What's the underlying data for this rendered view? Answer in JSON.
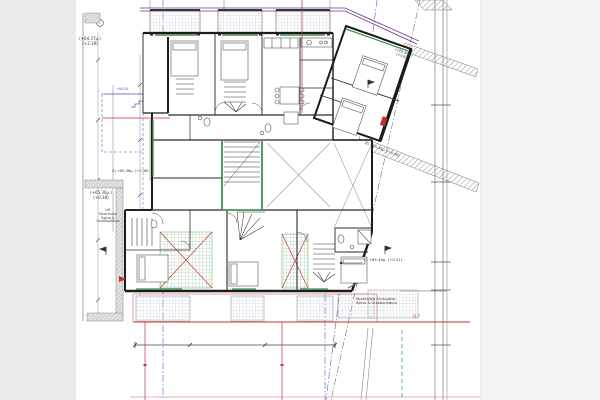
{
  "meta": {
    "kind": "architectural-floor-plan",
    "style": "CAD line drawing, top view, orthogonal building with rotated wing"
  },
  "palette": {
    "paper": "#ffffff",
    "margin_left": "#ebebeb",
    "margin_right": "#f3f3f2",
    "wall": "#1b1b1b",
    "green_accent": "#3f8f4f",
    "green_hatch": "#8fbc8f",
    "red_marker": "#c03030",
    "pink_boundary": "#cc7788",
    "blue_axis": "#5560c0",
    "purple_canopy": "#6a3a8a",
    "survey_gray": "#8a8a8a"
  },
  "annotations": {
    "level_top_left": {
      "line1": "(+64.37μ.)",
      "line2": "(+2.39)"
    },
    "level_left_small": {
      "line1": "(+65.36μ.)",
      "line2": "(+0.38)"
    },
    "level_z": "Ζ) +65.36μ. (+0.38)",
    "level_b": "Β) +65.46μ. (+0.48)",
    "level_c": "Γ) +65.49μ. (+0.51)",
    "level_wing": {
      "line1": "(+65.80μ.)",
      "line2": "(+0.82)"
    },
    "blue_level": "+64.05",
    "og_label": "Ο.Γ.",
    "left_note": {
      "0": "Lift",
      "1": "Ιδιοκτησία",
      "2": "Άρτια &",
      "3": "Οικοδομήσιμη"
    },
    "bottom_note": {
      "0": "Ιδιοκτησία Λευκωσίου",
      "1": "Άρτια & Οικοδομήσιμη"
    }
  }
}
